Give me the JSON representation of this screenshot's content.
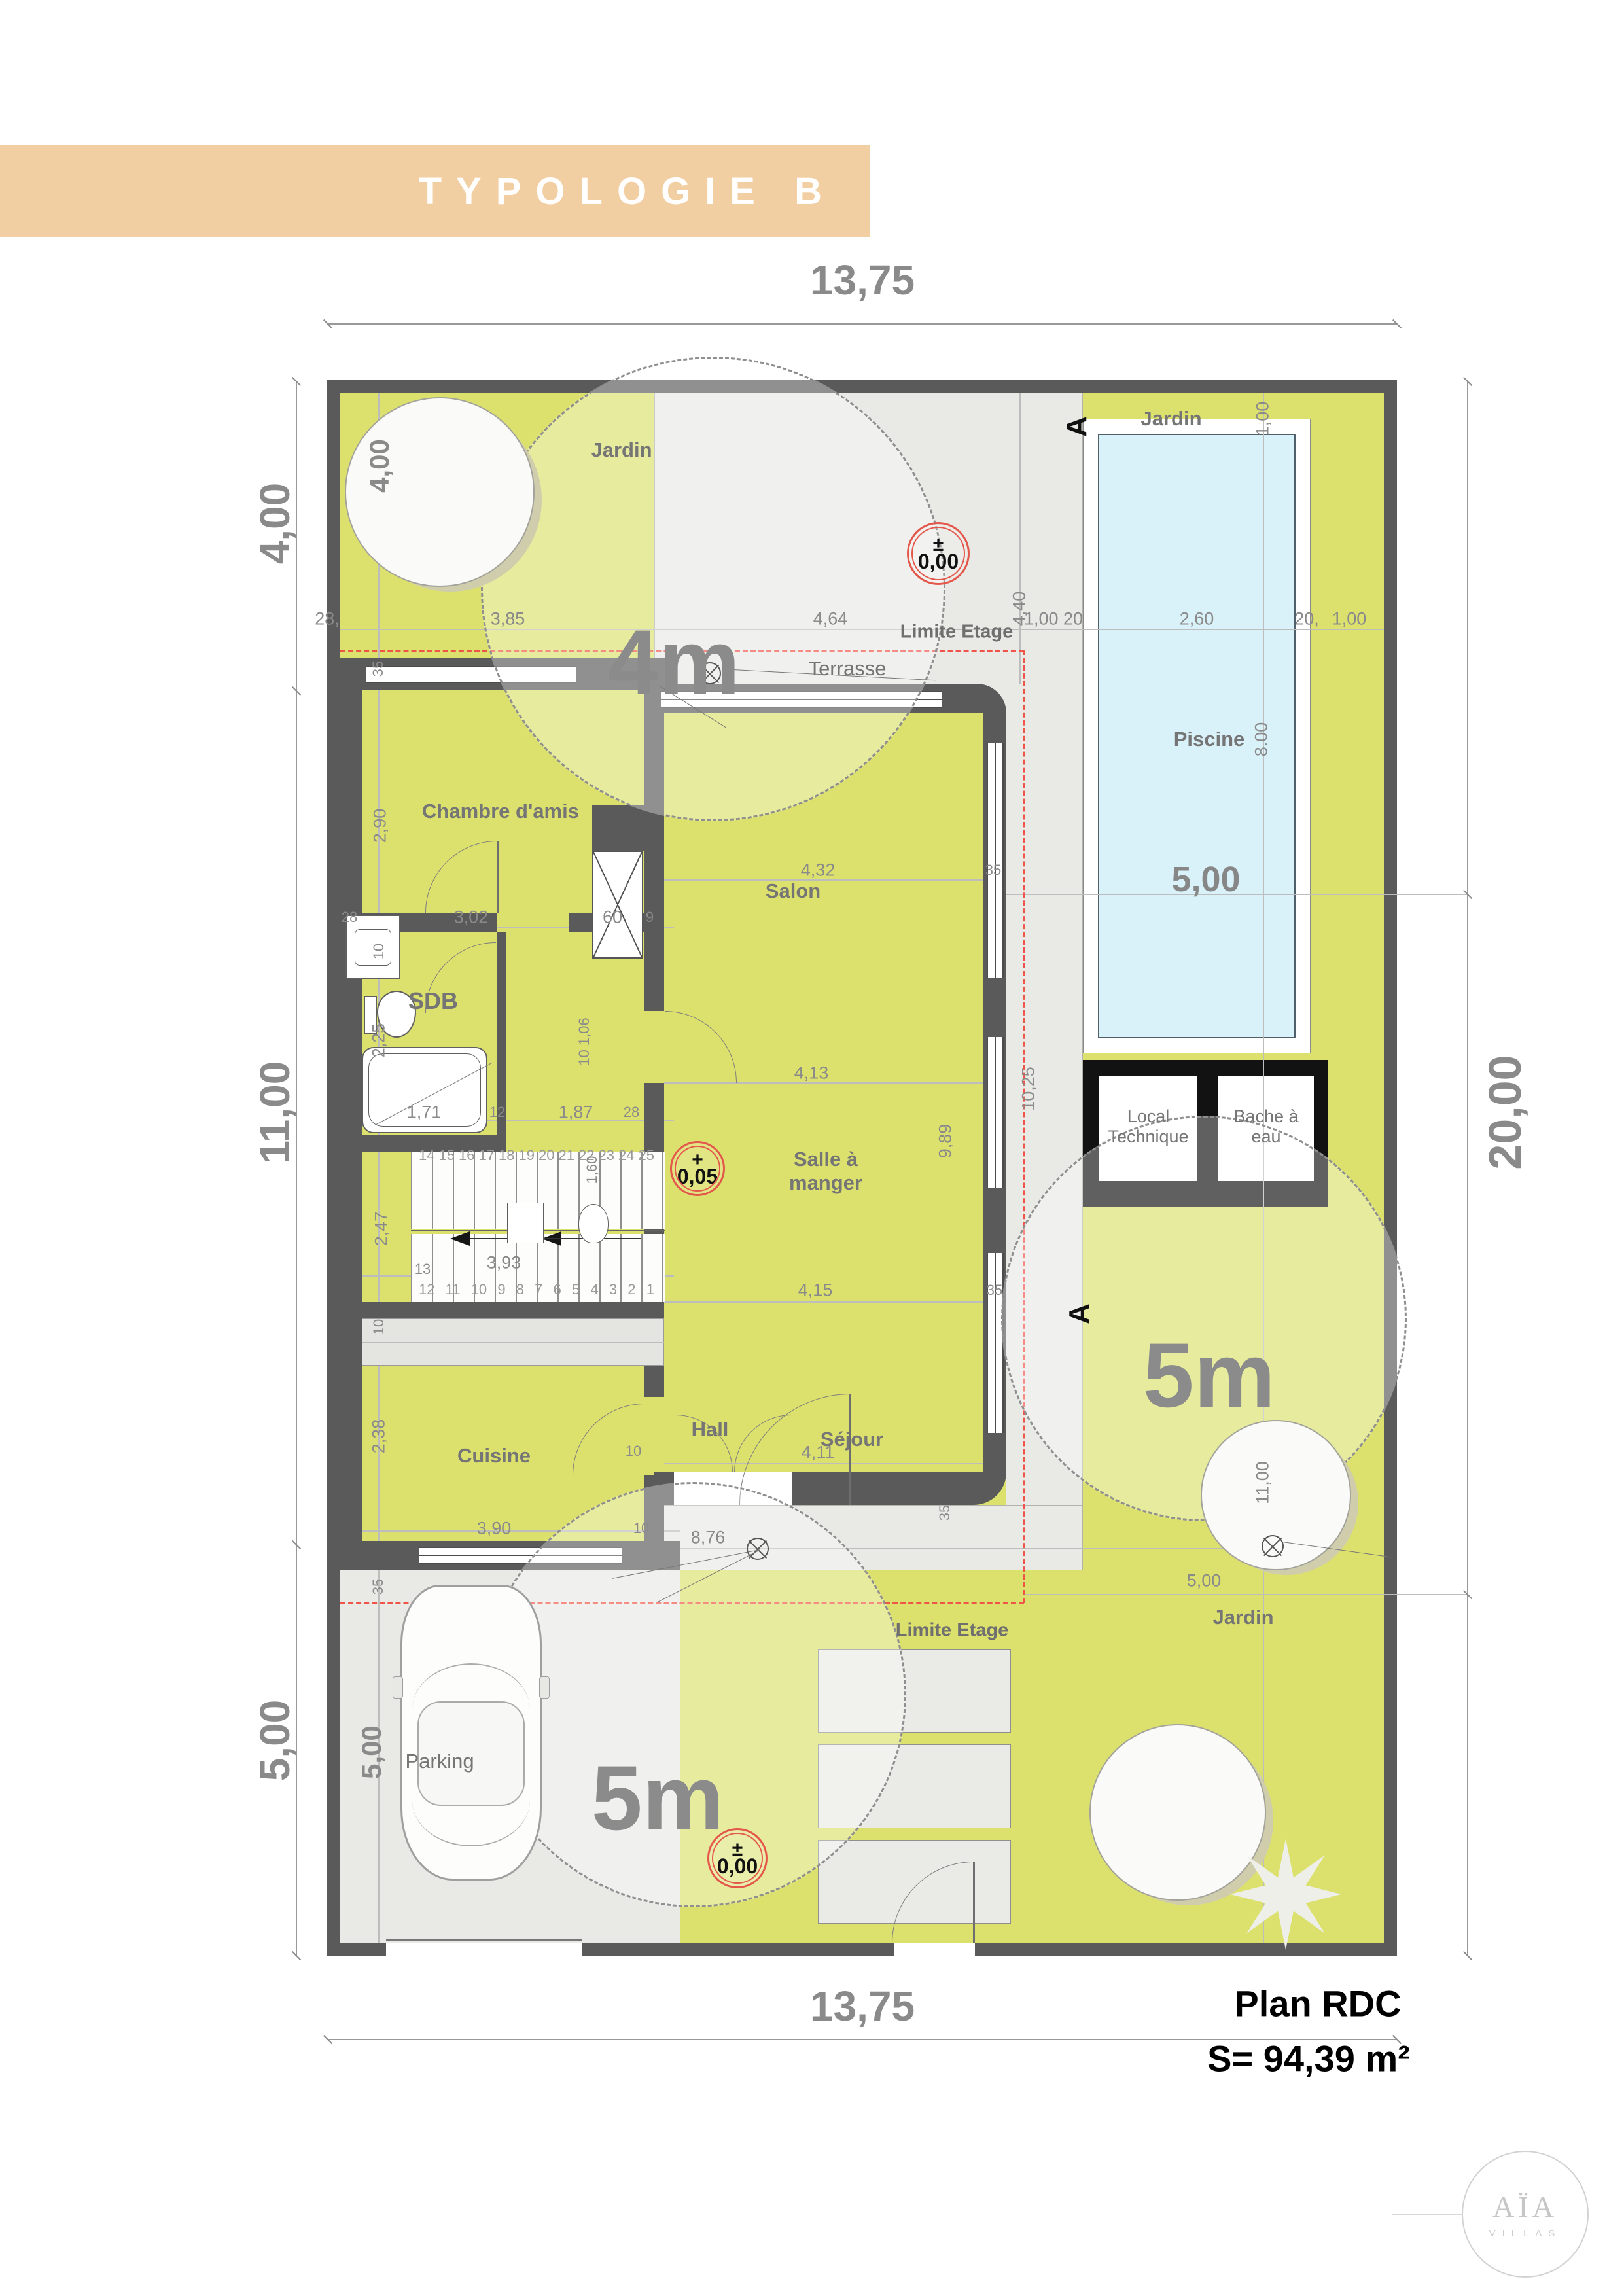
{
  "banner": {
    "title": "TYPOLOGIE B"
  },
  "footer": {
    "plan": "Plan RDC",
    "surface": "S= 94,39 m²"
  },
  "logo": {
    "brand": "AÏA",
    "sub": "VILLAS"
  },
  "rooms": {
    "chambre": "Chambre d'amis",
    "sdb": "SDB",
    "salon": "Salon",
    "salle": "Salle à manger",
    "cuisine": "Cuisine",
    "hall": "Hall",
    "sejour": "Séjour",
    "parking": "Parking",
    "terrasse": "Terrasse",
    "piscine": "Piscine",
    "local": "Local Technique",
    "bache": "Bache à eau"
  },
  "garden": {
    "label": "Jardin"
  },
  "zones": {
    "r4": "4m",
    "r5": "5m"
  },
  "levels": {
    "zero": {
      "sign": "±",
      "value": "0,00"
    },
    "plus": {
      "sign": "+",
      "value": "0,05"
    }
  },
  "annotations": {
    "limite": "Limite Etage",
    "section": "A"
  },
  "stairs": {
    "upper": [
      "14",
      "15",
      "16",
      "17",
      "18",
      "19",
      "20",
      "21",
      "22",
      "23",
      "24",
      "25"
    ],
    "lower": [
      "12",
      "11",
      "10",
      "9",
      "8",
      "7",
      "6",
      "5",
      "4",
      "3",
      "2",
      "1"
    ],
    "landing": "13"
  },
  "dims": {
    "top_total": "13,75",
    "bottom_total": "13,75",
    "left_a": "4,00",
    "left_b": "11,00",
    "left_c": "5,00",
    "right_total": "20,00",
    "r28": "28,",
    "r385": "3,85",
    "r464": "4,64",
    "r100_20": "1,00 20",
    "r260": "2,60",
    "r20": "20,",
    "r100": "1,00",
    "v400": "4,00",
    "v100": "1,00",
    "v440": "4,40",
    "pool_l": "8.00",
    "pool_w": "5,00",
    "pool_axis": "11,00",
    "garden_e": "5,00",
    "parking_w": "5,00",
    "ch_35": "35",
    "ch_h": "2,90",
    "ch_28": "28",
    "ch_w": "3,02",
    "ch_60": "60",
    "ch_9": "9",
    "ch_10": "10",
    "sdb_h": "2,25",
    "sdb_tub": "1,71",
    "sdb_12": "12",
    "cor_w": "1,87",
    "cor_28": "28",
    "cor_v": "10 1,06",
    "cor_160": "1,60",
    "st_247": "2,47",
    "st_393": "3,93",
    "sa_432": "4,32",
    "sa_35": "35",
    "sa_413": "4,13",
    "sa_989": "9,89",
    "sa_415": "4,15",
    "sa_35b": "35",
    "sa_1025": "10,25",
    "k_10": "10",
    "k_238": "2,38",
    "k_390": "3,90",
    "k_10b": "10",
    "k_35": "35",
    "se_411": "4,11",
    "se_10": "10",
    "se_35": "35",
    "walk_876": "8,76"
  },
  "colors": {
    "banner": "#f2cfa2",
    "garden": "#dce16e",
    "terrace": "#e9e9e6",
    "wall": "#5a5a5a",
    "pool_water": "#d9f1f8",
    "black_wall": "#121212",
    "dash_red": "#f05348",
    "marker_red": "#e4574b",
    "dim_text": "#8a8a8a",
    "room_text": "#757575"
  }
}
